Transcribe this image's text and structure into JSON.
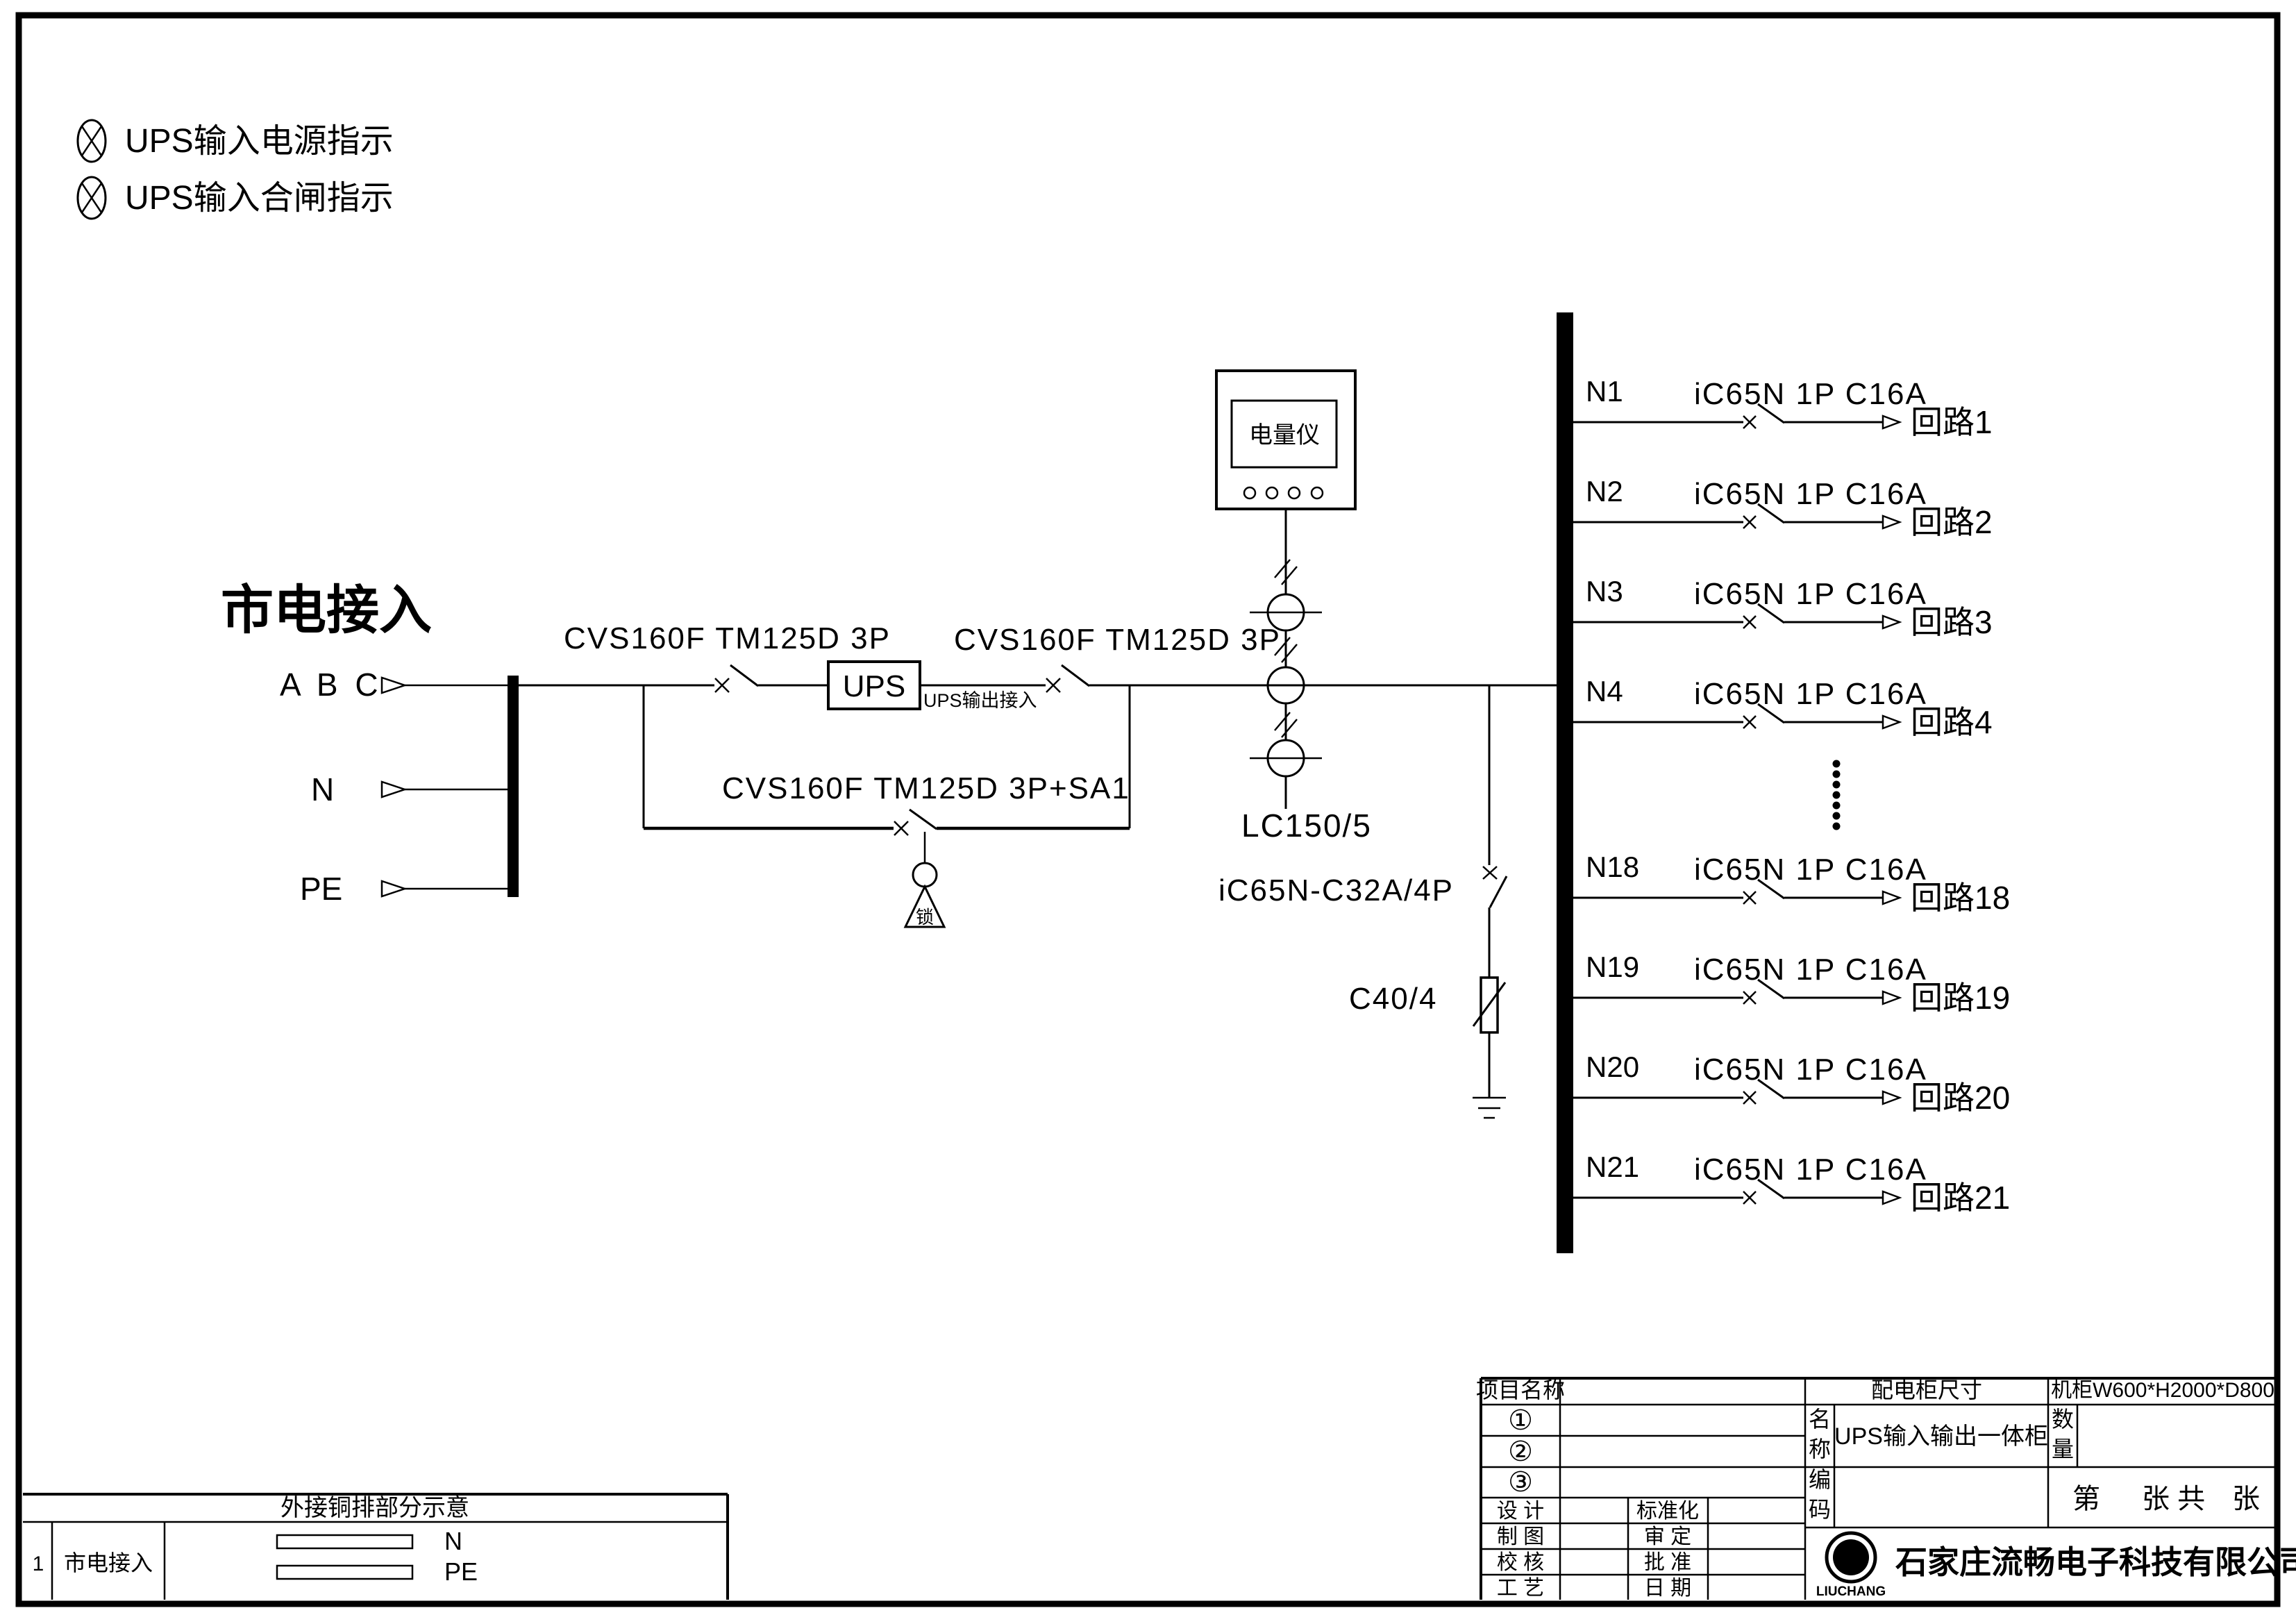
{
  "legend": {
    "items": [
      {
        "label": "UPS输入电源指示"
      },
      {
        "label": "UPS输入合闸指示"
      }
    ]
  },
  "source": {
    "title": "市电接入",
    "phases_label": "A B C",
    "neutral_label": "N",
    "pe_label": "PE"
  },
  "main_path": {
    "breaker1_label": "CVS160F TM125D 3P",
    "ups_label": "UPS",
    "ups_output_note": "UPS输出接入",
    "breaker2_label": "CVS160F TM125D 3P",
    "bypass_breaker_label": "CVS160F TM125D 3P+SA1",
    "lock_label": "锁",
    "meter_label": "电量仪",
    "ct_label": "LC150/5",
    "spd_switch_label": "iC65N-C32A/4P",
    "spd_label": "C40/4"
  },
  "feeders": {
    "breaker_label": "iC65N 1P C16A",
    "rows": [
      {
        "id": "N1",
        "circuit": "回路1"
      },
      {
        "id": "N2",
        "circuit": "回路2"
      },
      {
        "id": "N3",
        "circuit": "回路3"
      },
      {
        "id": "N4",
        "circuit": "回路4"
      },
      {
        "id": "N18",
        "circuit": "回路18"
      },
      {
        "id": "N19",
        "circuit": "回路19"
      },
      {
        "id": "N20",
        "circuit": "回路20"
      },
      {
        "id": "N21",
        "circuit": "回路21"
      }
    ]
  },
  "title_block": {
    "project_label": "项目名称",
    "row1_label": "①",
    "row2_label": "②",
    "row3_label": "③",
    "design_label": "设  计",
    "draft_label": "制  图",
    "check_label": "校  核",
    "process_label": "工  艺",
    "standard_label": "标准化",
    "review_label": "审  定",
    "approve_label": "批  准",
    "date_label": "日  期",
    "cabinet_size_label": "配电柜尺寸",
    "cabinet_size_value": "机柜W600*H2000*D800",
    "name_label": "名称",
    "name_value": "UPS输入输出一体柜",
    "qty_label": "数量",
    "code_label": "编码",
    "sheet_no_label": "第",
    "sheet_mid_label": "张 共",
    "sheet_end_label": "张"
  },
  "bottom_table": {
    "header": "外接铜排部分示意",
    "row_no": "1",
    "row_label": "市电接入",
    "bar1_label": "N",
    "bar2_label": "PE"
  },
  "company": {
    "logo_letter": "G",
    "logo_text": "LIUCHANG",
    "name": "石家庄流畅电子科技有限公司"
  }
}
